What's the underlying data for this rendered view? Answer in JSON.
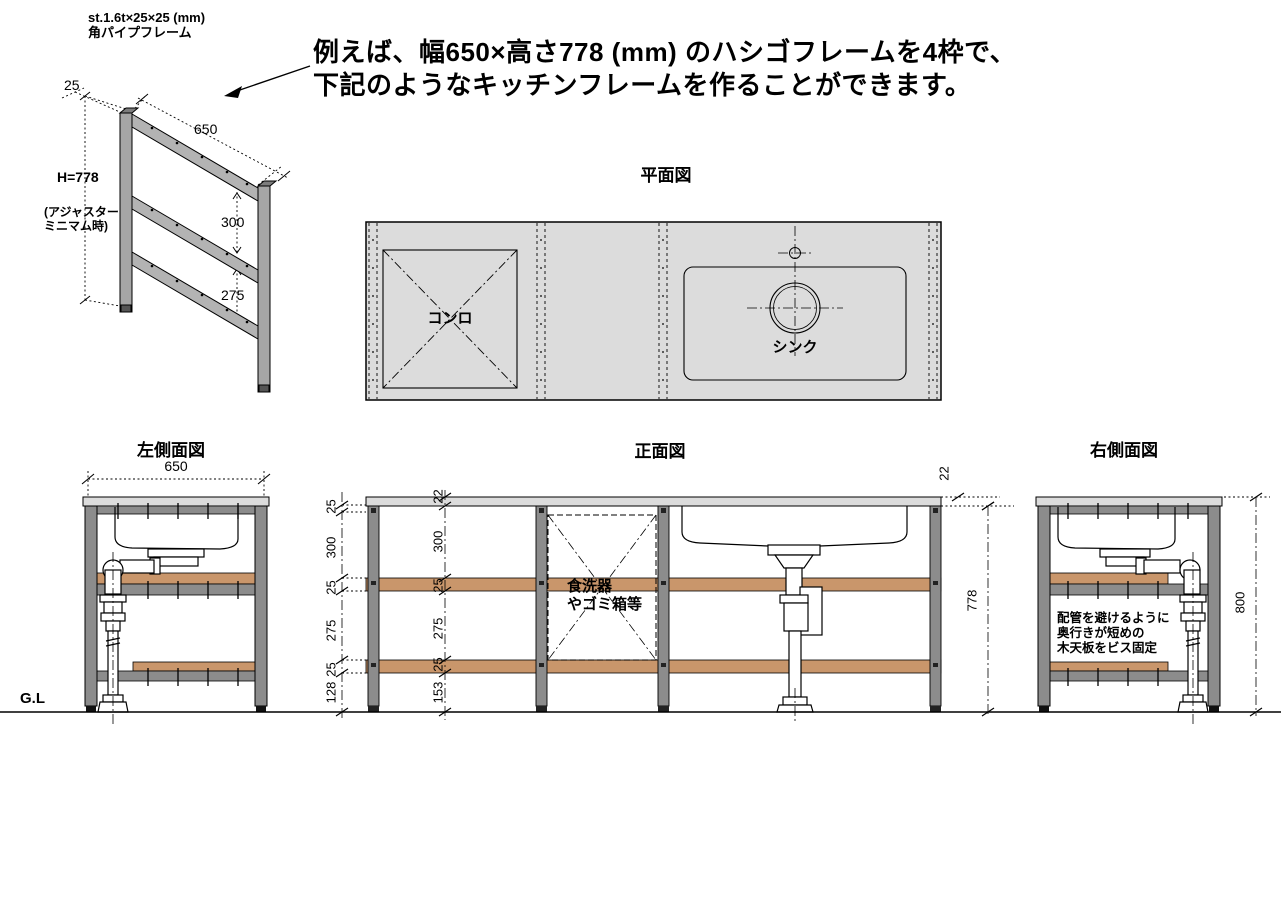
{
  "header": {
    "spec_line1": "st.1.6t×25×25 (mm)",
    "spec_line2": "角パイプフレーム",
    "heading_line1": "例えば、幅650×高さ778 (mm) のハシゴフレームを4枠で、",
    "heading_line2": "下記のようなキッチンフレームを作ることができます。"
  },
  "iso_frame": {
    "post_width_dim": "25",
    "width_dim": "650",
    "height_dim": "H=778",
    "height_note_line1": "(アジャスター",
    "height_note_line2": "ミニマム時)",
    "upper_span_dim": "300",
    "lower_span_dim": "275"
  },
  "plan_view": {
    "title": "平面図",
    "stove_label": "コンロ",
    "sink_label": "シンク"
  },
  "left_view": {
    "title": "左側面図",
    "width_dim": "650"
  },
  "front_view": {
    "title": "正面図",
    "left_dims": [
      "25",
      "300",
      "25",
      "275",
      "25",
      "128"
    ],
    "inner_dims": [
      "22",
      "300",
      "25",
      "275",
      "25",
      "153"
    ],
    "counter_thickness_dim": "22",
    "frame_height_dim": "778",
    "bay_label_line1": "食洗器",
    "bay_label_line2": "やゴミ箱等"
  },
  "right_view": {
    "title": "右側面図",
    "overall_height_dim": "800",
    "note_line1": "配管を避けるように",
    "note_line2": "奥行きが短めの",
    "note_line3": "木天板をビス固定"
  },
  "ground": {
    "label": "G.L"
  },
  "colors": {
    "wood": "#c9966b",
    "frame_gray": "#8c8c8c",
    "counter_gray": "#dcdcdc",
    "plan_bg": "#dcdcdc",
    "line": "#000000"
  }
}
